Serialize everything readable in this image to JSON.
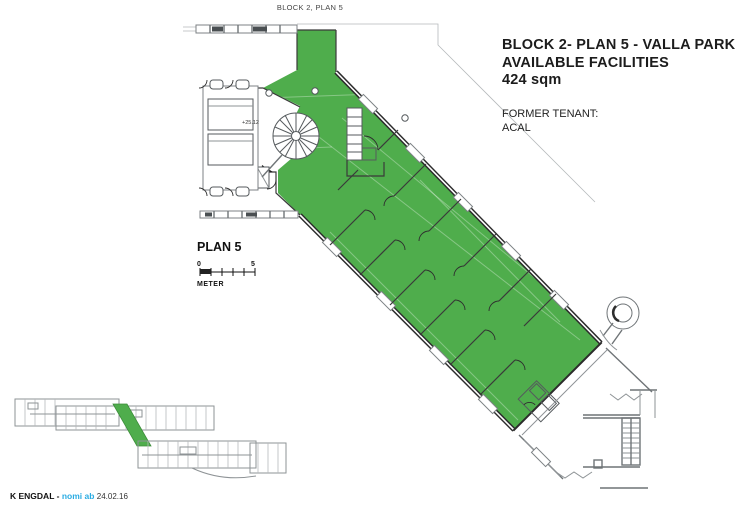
{
  "document": {
    "top_label": "BLOCK 2, PLAN 5",
    "title_block": {
      "line1": "BLOCK 2- PLAN 5 - VALLA PARK",
      "line2": "AVAILABLE FACILITIES",
      "line3": "424 sqm",
      "former_tenant_label": "FORMER TENANT:",
      "former_tenant_name": "ACAL"
    },
    "plan_label": "PLAN 5",
    "scale_bar": {
      "start": "0",
      "end": "5",
      "unit": "METER"
    },
    "annotations": {
      "elevation": "+25.12"
    },
    "footer": {
      "author": "K ENGDAL -",
      "studio": "nomi ab",
      "date": "24.02.16"
    }
  },
  "colors": {
    "highlight-green": "#4fad4c",
    "accent-cyan": "#29abe2",
    "plan-gray": "#8e9396",
    "wall-dark": "#2b2b2b"
  }
}
